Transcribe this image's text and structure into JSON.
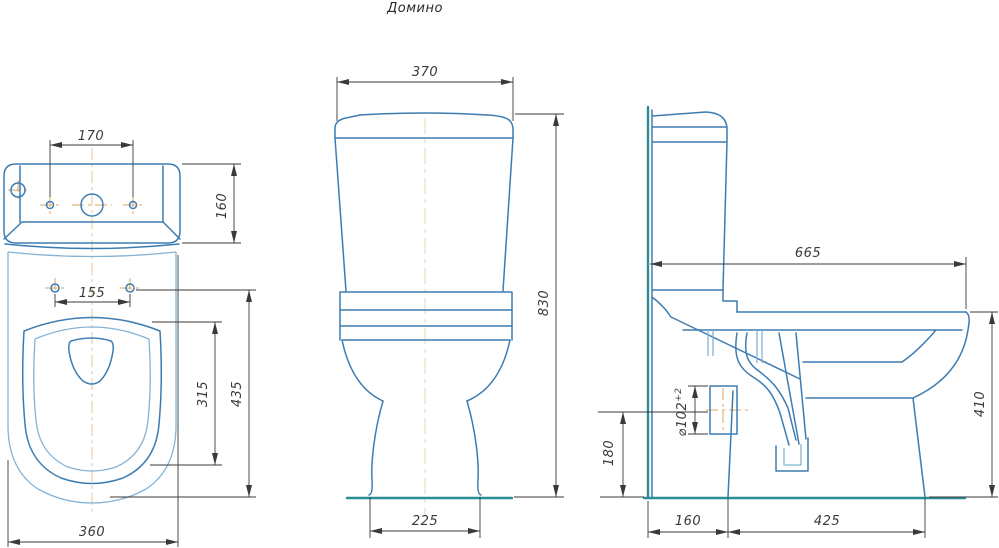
{
  "title": "Домино",
  "colors": {
    "outline": "#3d7cb1",
    "outline_light": "#85b3d4",
    "ground": "#2b8e96",
    "dimension": "#3a3a3a",
    "centerline": "#d8a963",
    "centerline_faint": "#e7dfc4",
    "background": "#ffffff"
  },
  "views": {
    "top_view": {
      "dims": {
        "lid_holes_spacing": "170",
        "tank_depth": "160",
        "seat_bolt_spacing": "155",
        "bowl_inner_length": "315",
        "bowl_length": "435",
        "bowl_width": "360"
      }
    },
    "front_view": {
      "dims": {
        "tank_width": "370",
        "overall_height": "830",
        "base_width": "225"
      }
    },
    "side_view": {
      "dims": {
        "overall_depth": "665",
        "bowl_height": "410",
        "outlet_axis_height": "180",
        "outlet_diameter": "⌀102",
        "outlet_diameter_tolerance": "+2",
        "wall_to_base": "160",
        "base_depth": "425"
      }
    }
  }
}
